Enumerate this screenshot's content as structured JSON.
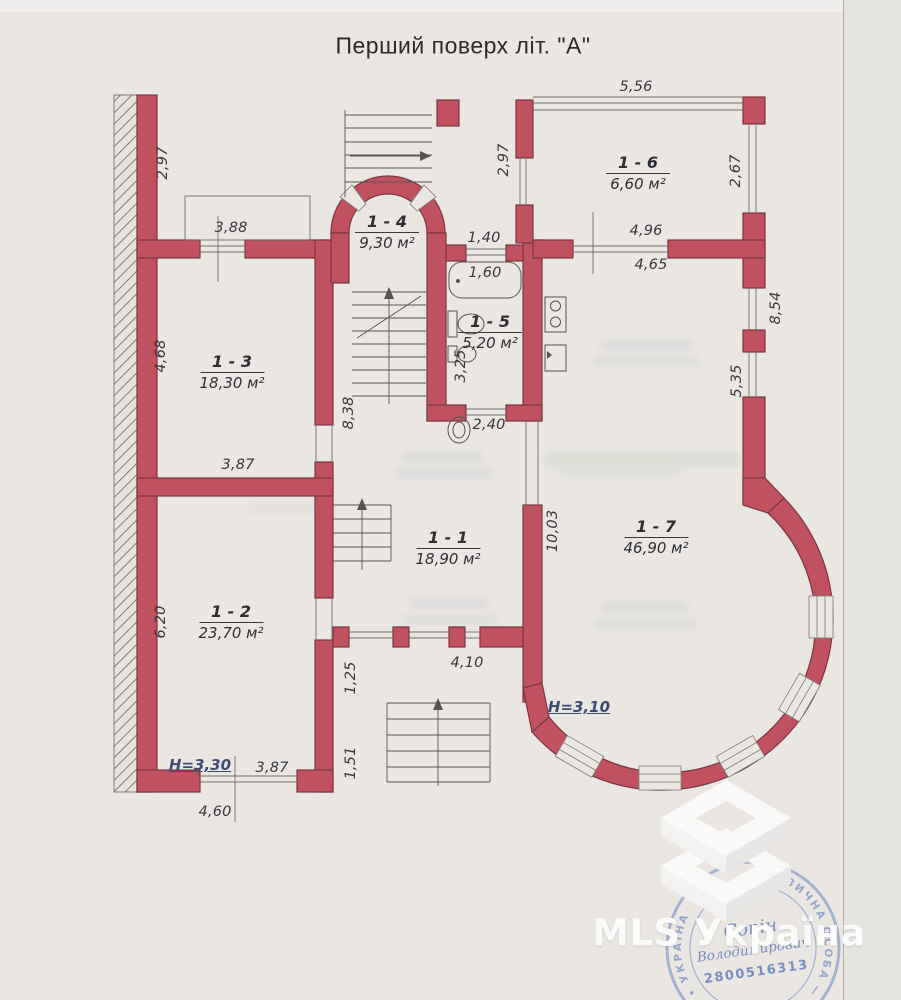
{
  "header": {
    "title": "Перший поверх літ. \"А\""
  },
  "rooms": {
    "r1": {
      "num": "1 - 1",
      "area": "18,90 м²"
    },
    "r2": {
      "num": "1 - 2",
      "area": "23,70 м²"
    },
    "r3": {
      "num": "1 - 3",
      "area": "18,30 м²"
    },
    "r4": {
      "num": "1 - 4",
      "area": "9,30 м²"
    },
    "r5": {
      "num": "1 - 5",
      "area": "5,20 м²"
    },
    "r6": {
      "num": "1 - 6",
      "area": "6,60 м²"
    },
    "r7": {
      "num": "1 - 7",
      "area": "46,90 м²"
    }
  },
  "dims": {
    "d556": "5,56",
    "d297a": "2,97",
    "d297b": "2,97",
    "d267": "2,67",
    "d388": "3,88",
    "d140": "1,40",
    "d160": "1,60",
    "d496": "4,96",
    "d465": "4,65",
    "d854": "8,54",
    "d535": "5,35",
    "d468": "4,68",
    "d838": "8,38",
    "d325": "3,25",
    "d240": "2,40",
    "d387a": "3,87",
    "d387b": "3,87",
    "d1003": "10,03",
    "d620": "6,20",
    "d410": "4,10",
    "d125": "1,25",
    "d151": "1,51",
    "d460": "4,60"
  },
  "heights": {
    "hleft": "H=3,30",
    "hright": "H=3,10"
  },
  "watermark": {
    "brand": "MLS Україна"
  },
  "stamp": {
    "ring": "• ФІЗИЧНА ОСОБА — ПІДПРИЄМЕЦЬ • УКРАЇНА",
    "name1": "Сопін",
    "name2": "Володимирович",
    "number": "2800516313"
  },
  "colors": {
    "wall": "#c05260",
    "wall_outline": "#7a3640",
    "stamp_blue": "#6e89c0",
    "height_blue": "#3d4c74",
    "paper": "#eae7e3"
  }
}
